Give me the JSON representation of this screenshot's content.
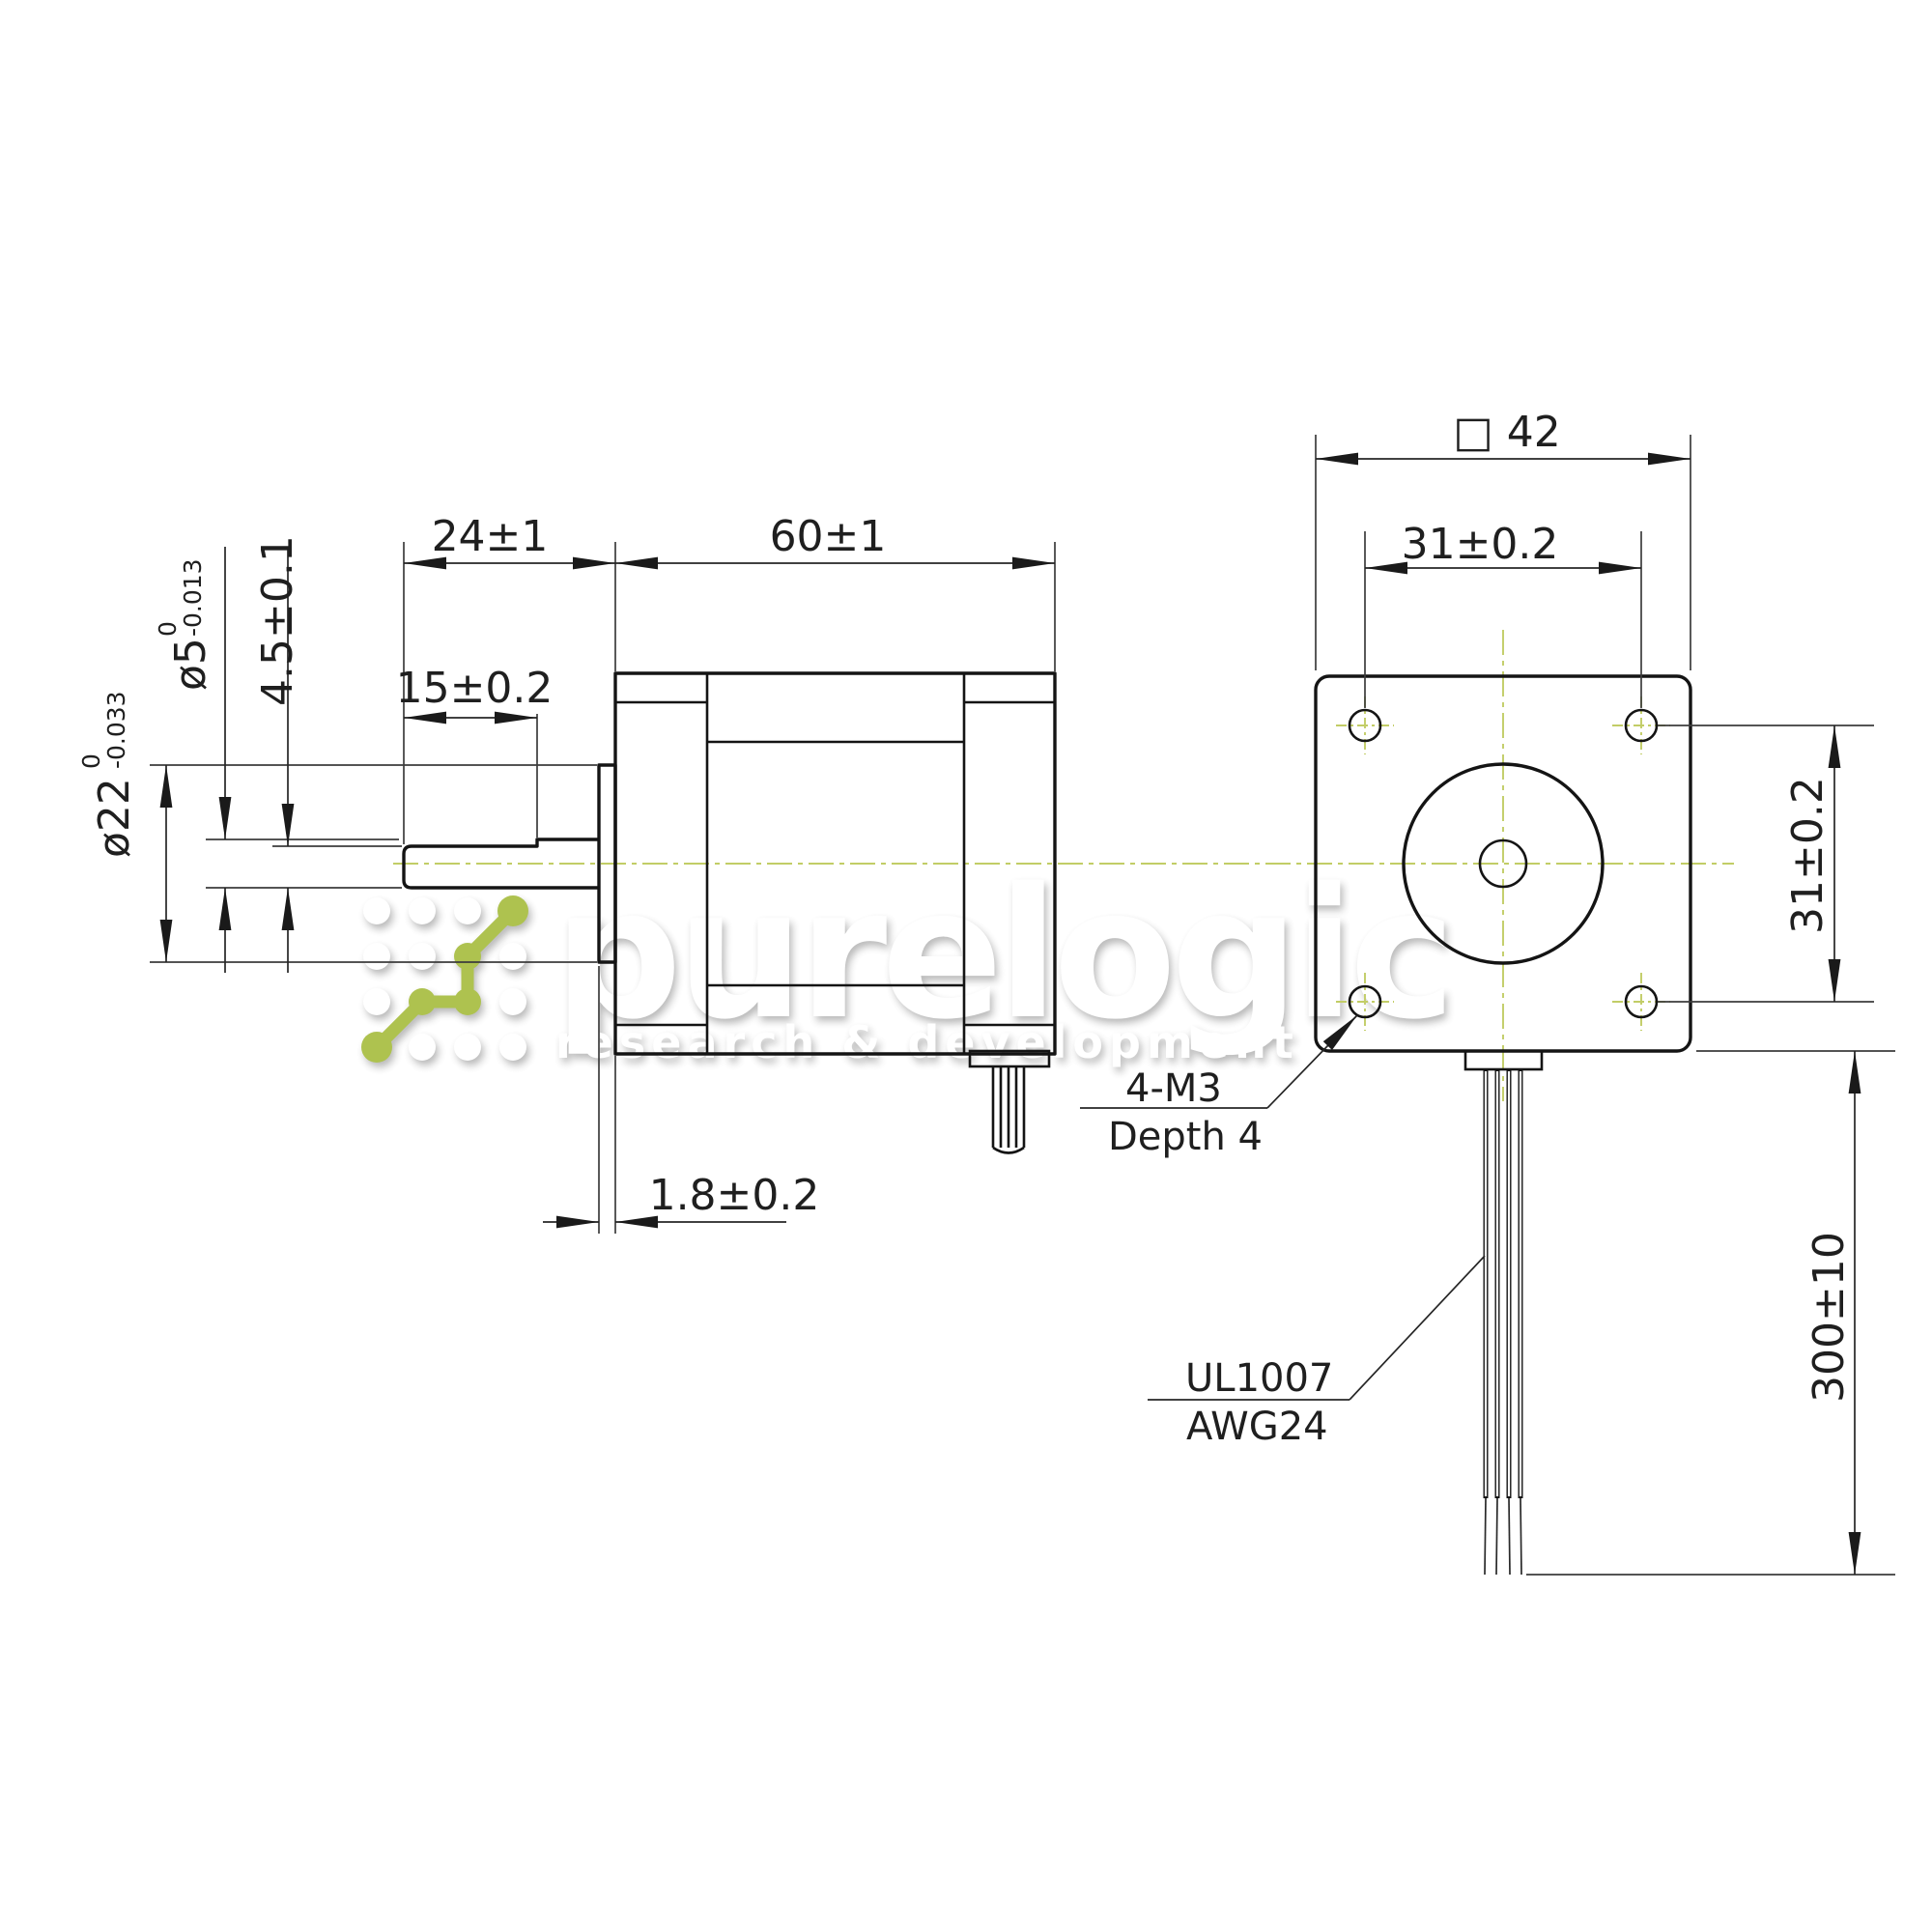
{
  "drawing": {
    "side_view": {
      "shaft_length": "24±1",
      "body_length": "60±1",
      "flat_length": "15±0.2",
      "flat_height": "4.5±0.1",
      "pilot_depth": "1.8±0.2",
      "shaft_diameter": {
        "value": "ø5",
        "tol_upper": "0",
        "tol_lower": "-0.013"
      },
      "pilot_diameter": {
        "value": "ø22",
        "tol_upper": "0",
        "tol_lower": "-0.033"
      }
    },
    "front_view": {
      "frame_size": "□ 42",
      "hole_spacing_horizontal": "31±0.2",
      "hole_spacing_vertical": "31±0.2",
      "lead_length": "300±10",
      "mounting_note": {
        "line1": "4-M3",
        "line2": "Depth 4"
      },
      "wire_note": {
        "line1": "UL1007",
        "line2": "AWG24"
      }
    }
  },
  "watermark": {
    "brand": "purelogic",
    "tagline": "research & development"
  },
  "colors": {
    "line": "#141414",
    "dimension_line": "#262626",
    "centerline_green": "#c2cd66",
    "accent_green": "#a9bf45",
    "background": "#ffffff",
    "watermark": "#ffffff"
  }
}
